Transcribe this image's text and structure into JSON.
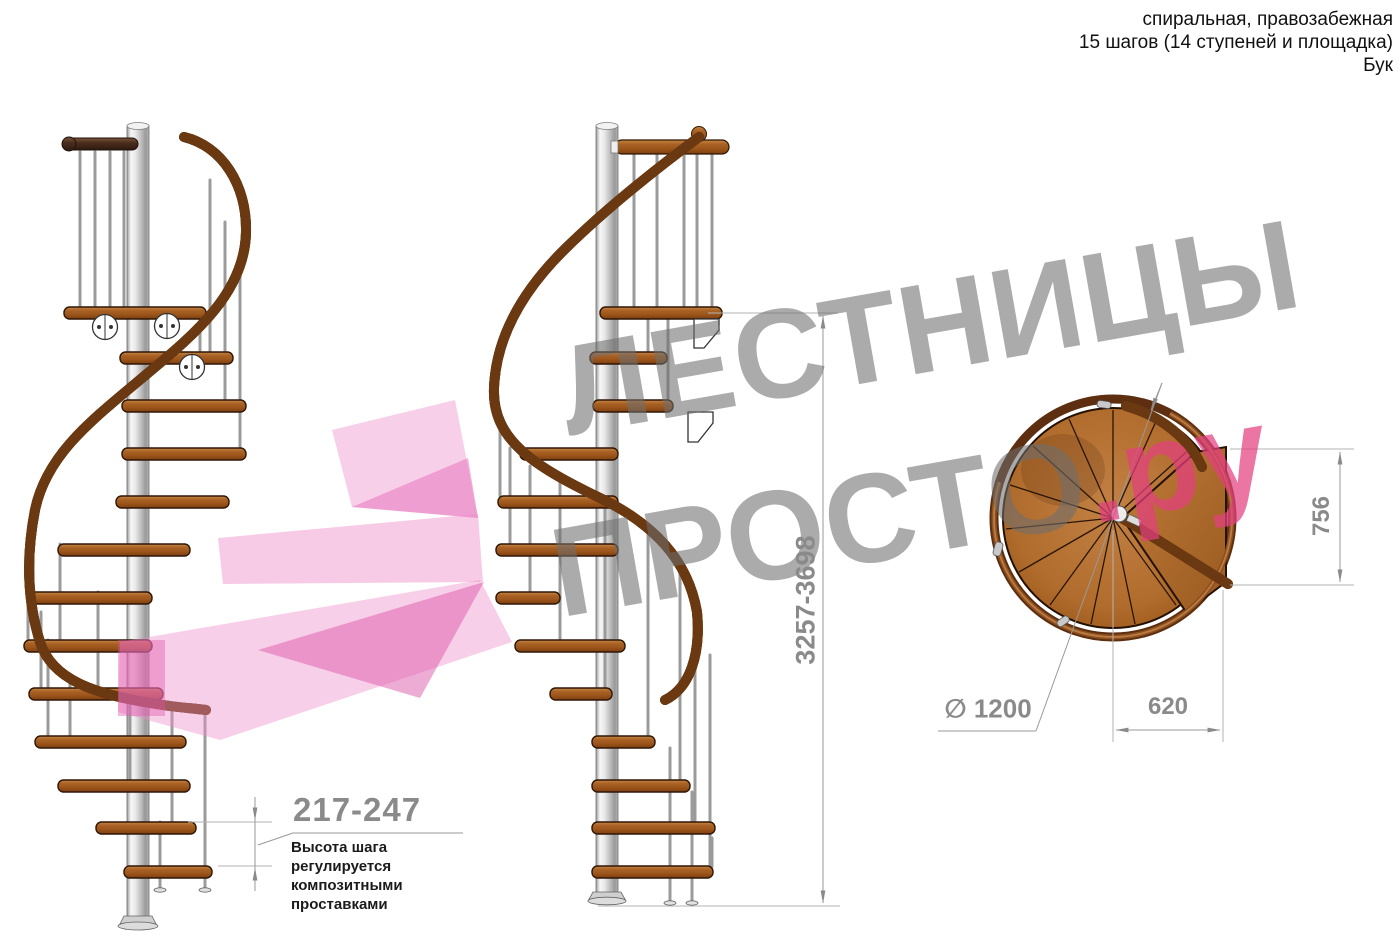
{
  "header": {
    "lines": [
      "спиральная, правозабежная",
      "15 шагов (14 ступеней и площадка)",
      "Бук"
    ]
  },
  "watermark": {
    "word1": "ЛЕСТНИЦЫ",
    "word2": "ПРОСТО",
    "word2_suffix": ".ру"
  },
  "dimensions": {
    "total_height": "3257-3698",
    "platform_width": "756",
    "step_length": "620",
    "diameter_symbol": "∅",
    "diameter_value": "1200",
    "step_height": "217-247"
  },
  "annotation": {
    "step_height_note": "Высота шага\nрегулируется\nкомпозитными\nпроставками"
  },
  "colors": {
    "dimension_gray": "#8a8a8a",
    "watermark_gray": "#6e6e6e",
    "watermark_pink": "#e3407f",
    "logo_pink": "#ee8cc8",
    "step_wood": "#a96226",
    "handrail_wood": "#9e5a22",
    "dark_rail_wood": "#4a2e1d",
    "pole_metal": "#c2c2c2"
  }
}
